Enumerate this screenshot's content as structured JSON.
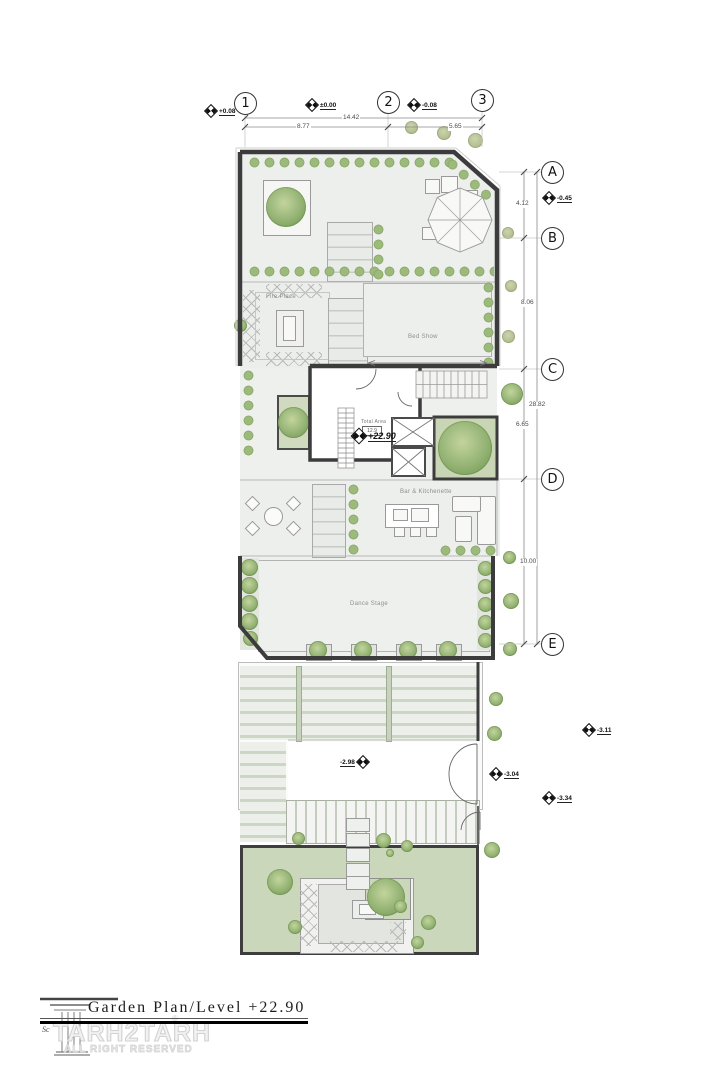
{
  "grid_bubbles": {
    "top": [
      "1",
      "2",
      "3"
    ],
    "side": [
      "A",
      "B",
      "C",
      "D",
      "E"
    ]
  },
  "dimensions": {
    "top_overall": "14.42",
    "top_left_seg": "8.77",
    "top_right_seg": "5.65",
    "side_overall": "28.82",
    "seg_ab": "4.12",
    "seg_bc": "8.06",
    "seg_cd": "6.65",
    "seg_de": "10.00"
  },
  "levels": {
    "top_left": "+0.08",
    "top_mid": "±0.00",
    "top_right": "-0.08",
    "side": "-0.45",
    "core": "+22.90",
    "landing": "-2.98",
    "door": "-3.04",
    "yard_upper": "-3.11",
    "yard_lower": "-3.34"
  },
  "rooms": {
    "fire_place": "Fire Place",
    "bed_show": "Bed Show",
    "total_area_label": "Total Area",
    "total_area_value": "12.9",
    "bar_kitchenette": "Bar & Kitchenette",
    "dance_stage": "Dance Stage"
  },
  "title_block": {
    "title": "Garden Plan/Level +22.90",
    "brand": "TARH2TARH",
    "registered": "®",
    "rights": "ALL RIGHT RESERVED",
    "scale_fragment": "Sc"
  },
  "colors": {
    "wall": "#3c3c3c",
    "plan_fill": "#edefec",
    "garden": "#cbd7ba",
    "tree": "#8fae6f"
  }
}
